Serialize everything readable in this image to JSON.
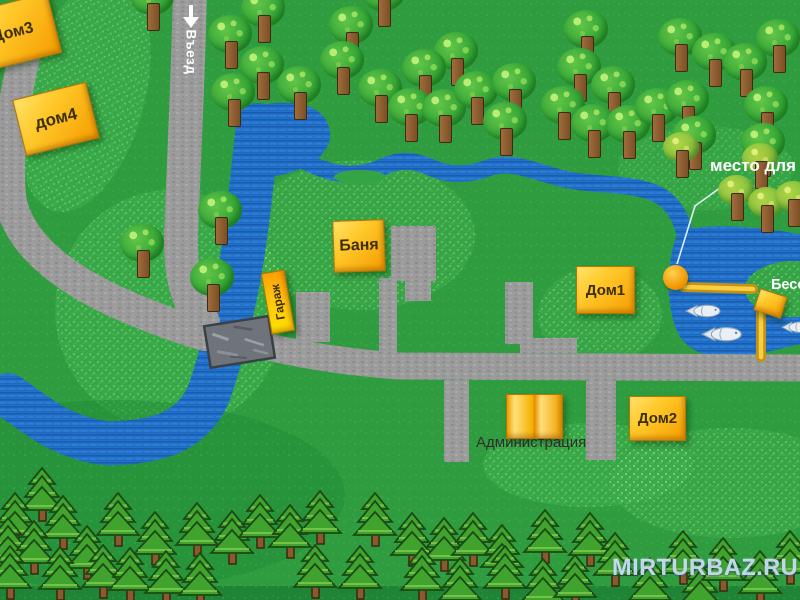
{
  "map_type": "recreation-base-site-map",
  "colors": {
    "grass": "#2f9d3f",
    "grass_light": "#3fae4e",
    "grass_dark": "#1f8c38",
    "water": "#2273cc",
    "water_stripe": "#1a5cb0",
    "road": "#9b9b9b",
    "bridge": "#6e747a",
    "building_orange": "#f8a800",
    "walkway_gold": "#d9a516",
    "building_label": "#3d2f05",
    "white_label": "#ffffff"
  },
  "labels": {
    "entrance": "Въезд",
    "dom3": "Дом3",
    "dom4": "дом4",
    "banya": "Баня",
    "garage": "Гараж",
    "dom1": "Дом1",
    "dom2": "Дом2",
    "administration": "Администрация",
    "gazebo": "Беседка",
    "fishing_spot": "место для",
    "watermark": "MIRTURBAZ.RU"
  },
  "icons": {
    "entrance_arrow": "down-arrow-icon",
    "tree": "tree-icon",
    "pine": "pine-tree-icon",
    "fish": "fish-icon",
    "marker_circle": "fishing-spot-marker"
  },
  "features": {
    "deciduous_trees": [
      [
        152,
        -4
      ],
      [
        383,
        -8
      ],
      [
        263,
        8
      ],
      [
        351,
        25
      ],
      [
        230,
        34
      ],
      [
        456,
        51
      ],
      [
        424,
        68
      ],
      [
        262,
        65
      ],
      [
        342,
        60
      ],
      [
        299,
        85
      ],
      [
        233,
        92
      ],
      [
        380,
        88
      ],
      [
        410,
        107
      ],
      [
        444,
        108
      ],
      [
        476,
        90
      ],
      [
        514,
        82
      ],
      [
        505,
        121
      ],
      [
        586,
        29
      ],
      [
        680,
        37
      ],
      [
        714,
        52
      ],
      [
        778,
        38
      ],
      [
        745,
        62
      ],
      [
        579,
        67
      ],
      [
        613,
        85
      ],
      [
        563,
        105
      ],
      [
        593,
        123
      ],
      [
        628,
        124
      ],
      [
        657,
        107
      ],
      [
        687,
        99
      ],
      [
        694,
        135
      ],
      [
        766,
        105
      ],
      [
        763,
        142
      ],
      [
        220,
        210
      ],
      [
        142,
        243
      ],
      [
        212,
        277
      ]
    ],
    "autumn_trees": [
      [
        681,
        147
      ],
      [
        760,
        158
      ],
      [
        736,
        190
      ],
      [
        766,
        202
      ],
      [
        793,
        196
      ]
    ],
    "pine_trees": [
      [
        42,
        495,
        1
      ],
      [
        15,
        520,
        1
      ],
      [
        63,
        523,
        1
      ],
      [
        8,
        545,
        1
      ],
      [
        34,
        548,
        1
      ],
      [
        87,
        553,
        1
      ],
      [
        118,
        520,
        1
      ],
      [
        155,
        539,
        1
      ],
      [
        197,
        530,
        1
      ],
      [
        232,
        538,
        1
      ],
      [
        260,
        522,
        1
      ],
      [
        290,
        532,
        1
      ],
      [
        320,
        518,
        1
      ],
      [
        375,
        520,
        1
      ],
      [
        412,
        540,
        1
      ],
      [
        444,
        545,
        1
      ],
      [
        473,
        540,
        1
      ],
      [
        502,
        552,
        1
      ],
      [
        545,
        537,
        1
      ],
      [
        590,
        540,
        1
      ],
      [
        10,
        573,
        1
      ],
      [
        60,
        574,
        1
      ],
      [
        103,
        572,
        1
      ],
      [
        130,
        575,
        1
      ],
      [
        166,
        578,
        1
      ],
      [
        200,
        580,
        1
      ],
      [
        315,
        572,
        1
      ],
      [
        360,
        573,
        1
      ],
      [
        422,
        575,
        1
      ],
      [
        460,
        585,
        1
      ],
      [
        505,
        573,
        1
      ],
      [
        543,
        586,
        1
      ],
      [
        575,
        582,
        1
      ],
      [
        615,
        560,
        1
      ],
      [
        650,
        585,
        1
      ],
      [
        683,
        558,
        1
      ],
      [
        700,
        590,
        1
      ],
      [
        723,
        565,
        1
      ],
      [
        760,
        578,
        1
      ],
      [
        790,
        558,
        1
      ]
    ],
    "fish": [
      [
        703,
        311,
        1
      ],
      [
        722,
        334,
        1.15
      ],
      [
        797,
        327,
        0.9
      ]
    ]
  }
}
